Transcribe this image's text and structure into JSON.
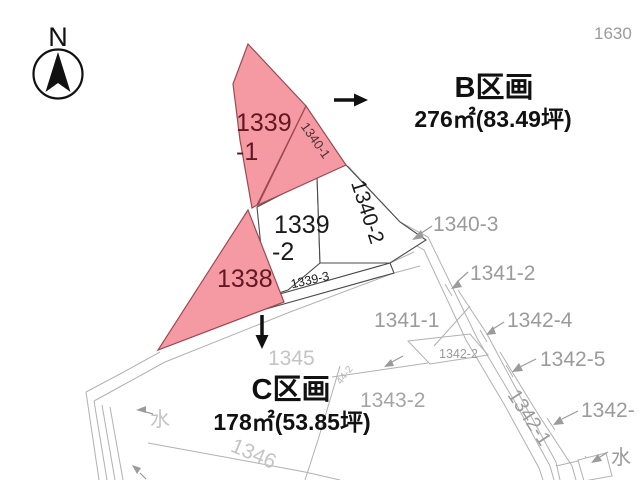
{
  "colors": {
    "highlight_fill": "#f59aa2",
    "highlight_stroke": "#9a4a52",
    "highlight_text": "#611821",
    "ink": "#1a1a1a",
    "label_gray": "#9b9b9b",
    "label_light_gray": "#c5c3c3",
    "line_gray": "#b3b0b0"
  },
  "compass": {
    "north_label": "N"
  },
  "corner_parcel_label": "1630",
  "sections": {
    "b": {
      "title": "B区画",
      "area": "276㎡(83.49坪)"
    },
    "c": {
      "title": "C区画",
      "area": "178㎡(53.85坪)"
    }
  },
  "highlighted_parcels": {
    "p1339_1": {
      "line1": "1339",
      "line2": "-1"
    },
    "p1338": {
      "label": "1338"
    },
    "p1340_1": {
      "label": "1340-1"
    }
  },
  "white_parcels": {
    "p1339_2": {
      "line1": "1339",
      "line2": "-2"
    },
    "p1340_2": {
      "label": "1340-2"
    },
    "p1339_3": {
      "label": "1339-3"
    }
  },
  "neighbor_labels": {
    "n1340_3": "1340-3",
    "n1341_2": "1341-2",
    "n1341_1": "1341-1",
    "n1342_4": "1342-4",
    "n1342_5": "1342-5",
    "n1342_2": "1342-2",
    "n1343_2": "1343-2",
    "n1342_cut": "1342-",
    "n1342_1": "1342-1",
    "n1345": "1345",
    "n1346": "1346",
    "n44_2": "44-2",
    "water_right": "水",
    "water_left": "水"
  }
}
